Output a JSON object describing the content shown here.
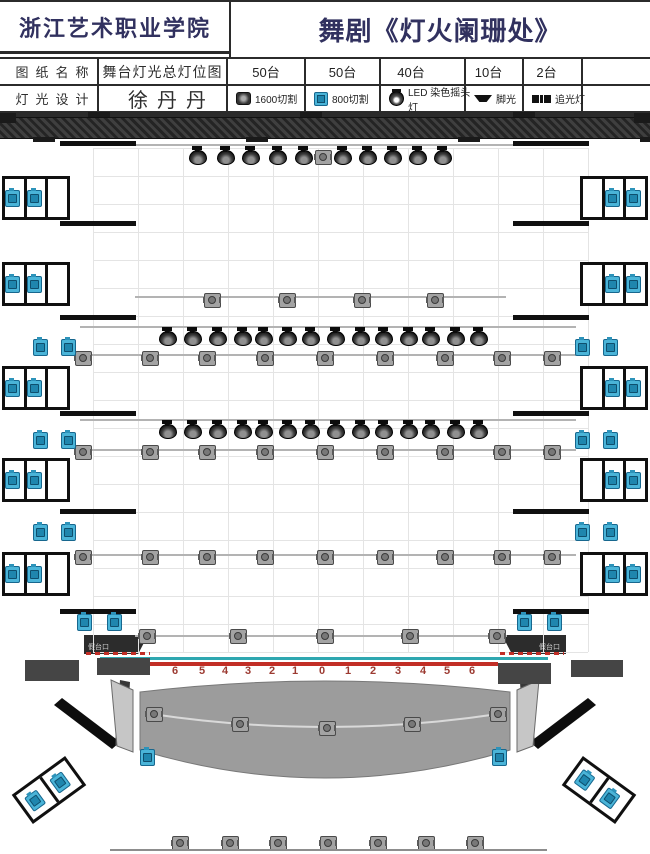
{
  "header": {
    "school": "浙江艺术职业学院",
    "title": "舞剧《灯火阑珊处》",
    "rows": [
      {
        "label": "图纸名称",
        "value": "舞台灯光总灯位图"
      },
      {
        "label": "灯光设计",
        "value": "徐丹丹"
      }
    ],
    "legend": [
      {
        "count": "50台",
        "name": "1600切割",
        "icon": "spot-1600-icon"
      },
      {
        "count": "50台",
        "name": "800切割",
        "icon": "spot-800-icon"
      },
      {
        "count": "40台",
        "name": "LED 染色摇头灯",
        "icon": "led-moving-head-icon"
      },
      {
        "count": "10台",
        "name": "脚光",
        "icon": "footlight-icon"
      },
      {
        "count": "2台",
        "name": "追光灯",
        "icon": "followspot-icon"
      }
    ]
  },
  "stage": {
    "prosc_left_label": "假台口",
    "prosc_right_label": "假台口",
    "scale_numbers": [
      "6",
      "5",
      "4",
      "3",
      "2",
      "1",
      "0",
      "1",
      "2",
      "3",
      "4",
      "5",
      "6"
    ],
    "colors": {
      "accent_teal": "#2ea7b0",
      "accent_red": "#c22e26",
      "number_red": "#9c3a31",
      "blue_fixture": "#4ab4d8"
    }
  },
  "layout": {
    "grid": {
      "x0": 93,
      "x1": 588,
      "xstep": 45,
      "y0": 148,
      "y1": 652,
      "ystep": 28
    },
    "battens": [
      [
        80,
        144,
        496
      ],
      [
        135,
        296,
        371
      ],
      [
        80,
        326,
        496
      ],
      [
        80,
        354,
        496
      ],
      [
        80,
        419,
        496
      ],
      [
        80,
        449,
        496
      ],
      [
        80,
        554,
        496
      ],
      [
        135,
        635,
        372
      ]
    ],
    "bar_pairs": {
      "ys": [
        141,
        221,
        315,
        411,
        509,
        609
      ],
      "left_x": 60,
      "right_x": 513,
      "w": 76
    },
    "head_rows": [
      {
        "y": 150,
        "xs": [
          197,
          225,
          250,
          277,
          303,
          342,
          367,
          392,
          417,
          442
        ]
      },
      {
        "y": 331,
        "xs": [
          167,
          192,
          217,
          242,
          263,
          287,
          310,
          335,
          360,
          383,
          408,
          430,
          455,
          478
        ]
      },
      {
        "y": 424,
        "xs": [
          167,
          192,
          217,
          242,
          263,
          287,
          310,
          335,
          360,
          383,
          408,
          430,
          455,
          478
        ]
      }
    ],
    "gray_rows": [
      {
        "y": 300,
        "xs": [
          212,
          287,
          362,
          435
        ]
      },
      {
        "y": 358,
        "xs": [
          83,
          150,
          207,
          265,
          325,
          385,
          445,
          502,
          552
        ]
      },
      {
        "y": 452,
        "xs": [
          83,
          150,
          207,
          265,
          325,
          385,
          445,
          502,
          552
        ]
      },
      {
        "y": 557,
        "xs": [
          83,
          150,
          207,
          265,
          325,
          385,
          445,
          502,
          552
        ]
      },
      {
        "y": 636,
        "xs": [
          147,
          238,
          325,
          410,
          497
        ]
      },
      {
        "y": 843,
        "xs": [
          180,
          230,
          278,
          328,
          378,
          426,
          475
        ]
      }
    ],
    "gray_points": [
      [
        323,
        157
      ],
      [
        154,
        714
      ],
      [
        240,
        724
      ],
      [
        327,
        728
      ],
      [
        412,
        724
      ],
      [
        498,
        714
      ]
    ],
    "blue_points": [
      [
        40,
        347
      ],
      [
        68,
        347
      ],
      [
        582,
        347
      ],
      [
        610,
        347
      ],
      [
        40,
        440
      ],
      [
        68,
        440
      ],
      [
        582,
        440
      ],
      [
        610,
        440
      ],
      [
        40,
        532
      ],
      [
        68,
        532
      ],
      [
        582,
        532
      ],
      [
        610,
        532
      ],
      [
        84,
        622
      ],
      [
        114,
        622
      ],
      [
        524,
        622
      ],
      [
        554,
        622
      ],
      [
        147,
        757
      ],
      [
        499,
        757
      ]
    ],
    "boxes": {
      "ys": [
        176,
        262,
        366,
        458,
        552
      ],
      "left_x": 2,
      "right_x": 580,
      "w": 68,
      "h": 44,
      "blue_cells_left": [
        0,
        1
      ],
      "blue_cells_right": [
        1,
        2
      ]
    },
    "tilted_boxes": [
      {
        "x": 16,
        "y": 772,
        "rot": -36
      },
      {
        "x": 566,
        "y": 772,
        "rot": 36
      }
    ],
    "numbers": {
      "y": 665,
      "xs": [
        175,
        202,
        225,
        248,
        272,
        295,
        322,
        348,
        373,
        398,
        423,
        447,
        472
      ]
    },
    "blocks": [
      [
        25,
        660,
        54,
        21
      ],
      [
        97,
        658,
        53,
        17
      ],
      [
        498,
        663,
        53,
        21
      ],
      [
        571,
        660,
        52,
        17
      ]
    ],
    "teal_line": [
      100,
      657,
      448
    ],
    "red_line": [
      150,
      662,
      348
    ],
    "red_dashes": [
      [
        86,
        652,
        64
      ],
      [
        500,
        652,
        64
      ]
    ],
    "bottom_line": [
      110,
      849,
      437
    ],
    "hatch": {
      "y": 117,
      "tabs_above": [
        88,
        300,
        513
      ],
      "tabs_below": [
        33,
        246,
        458,
        640
      ],
      "caps": [
        [
          0,
          113
        ],
        [
          634,
          113
        ]
      ]
    }
  }
}
